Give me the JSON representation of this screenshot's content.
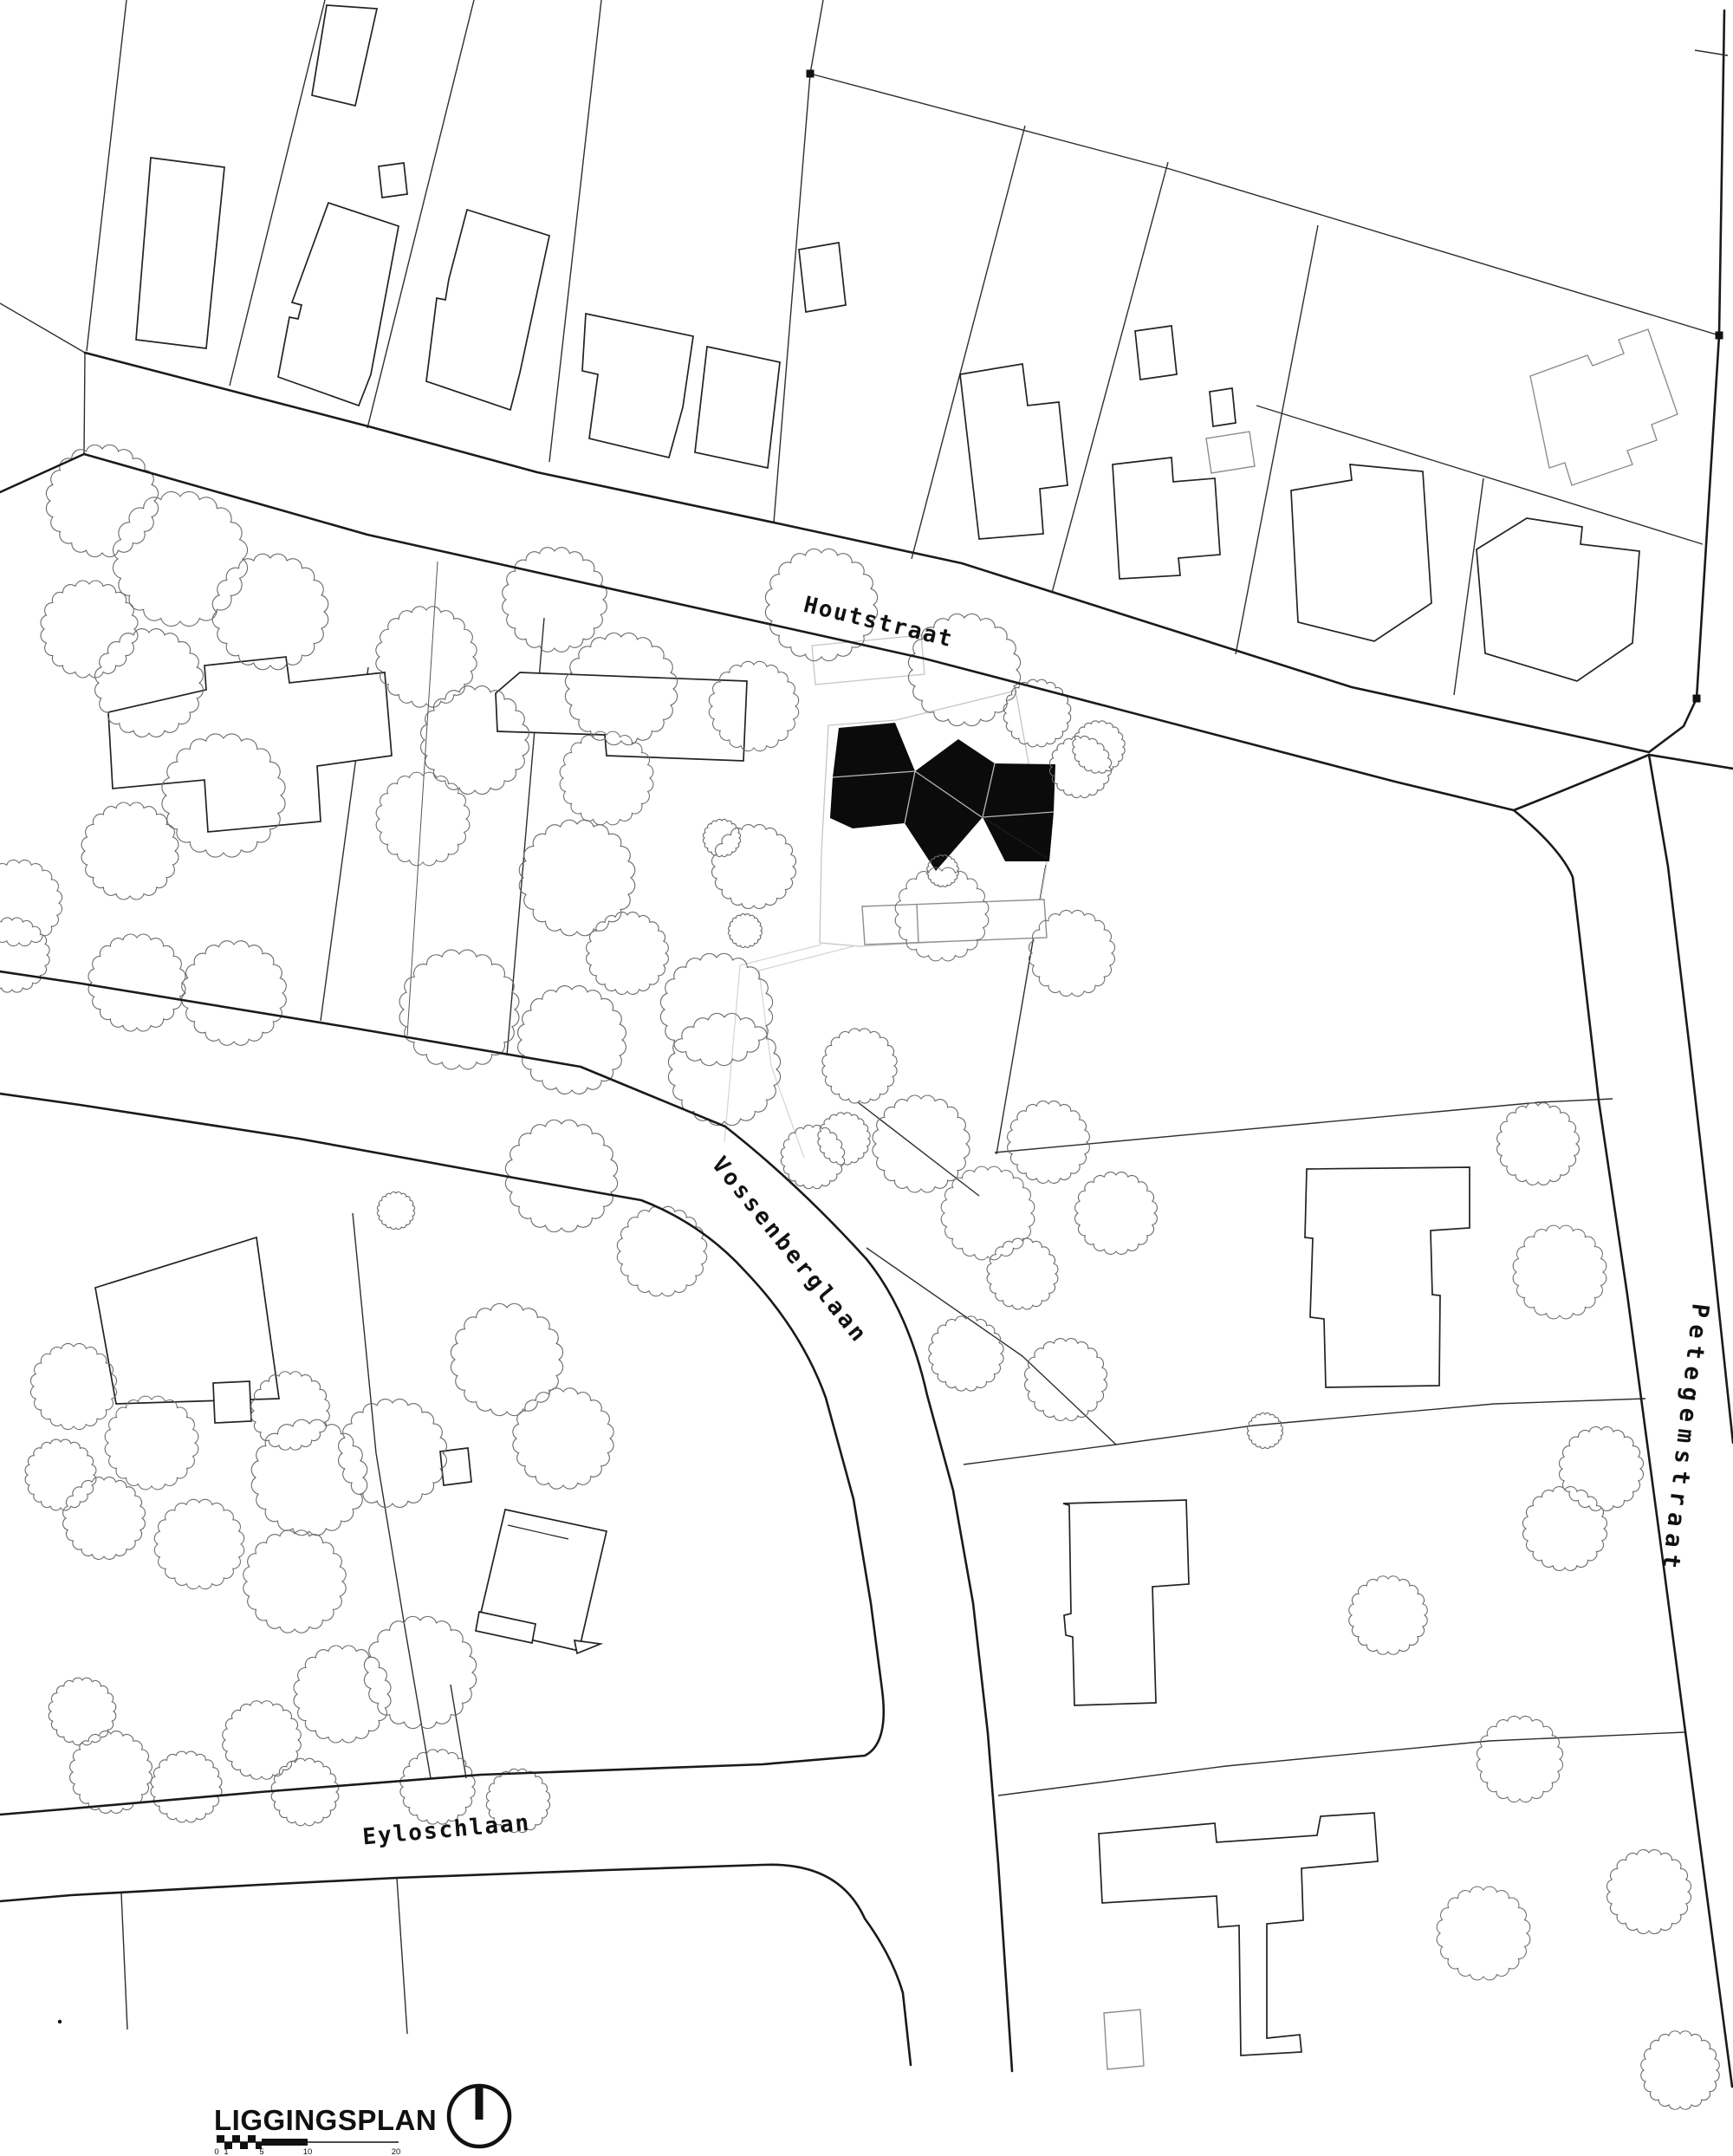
{
  "streets": {
    "houtstraat": "Houtstraat",
    "vossenberglaan": "Vossenberglaan",
    "petegemstraat": "Petegemstraat",
    "eyloschlaan": "Eyloschlaan"
  },
  "legend": {
    "title": "LIGGINGSPLAN",
    "scale_ticks": [
      "0",
      "1",
      "5",
      "10",
      "20"
    ]
  },
  "colors": {
    "ink": "#1a1a1a",
    "parcel": "#2e2e2e",
    "tree": "#6b6b6b",
    "light_gray": "#c5c5c5",
    "mid_gray": "#8d8d8d",
    "highlight_black": "#0b0b0b",
    "background": "#ffffff"
  }
}
